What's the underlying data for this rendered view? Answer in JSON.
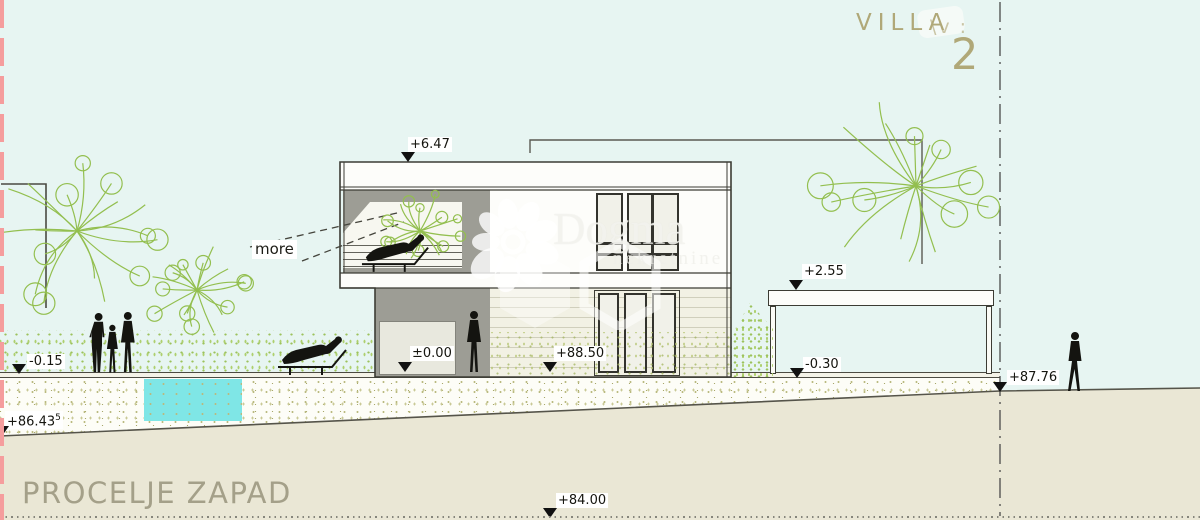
{
  "title": {
    "project": "VILLA",
    "ghost_text": "\\v :",
    "number": "2",
    "facade_name": "PROCELJE ZAPAD"
  },
  "annotations": {
    "more_label": "more"
  },
  "watermark": {
    "name": "Dogma",
    "subtitle": "nekretnine"
  },
  "elevation_markers": [
    {
      "id": "roof-level",
      "label": "+6.47",
      "label_x": 408,
      "label_y": 137,
      "tri_x": 401,
      "tri_y": 152
    },
    {
      "id": "ground-floor-level",
      "label": "±0.00",
      "label_x": 410,
      "label_y": 346,
      "tri_x": 398,
      "tri_y": 362
    },
    {
      "id": "absolute-8850",
      "label": "+88.50",
      "label_x": 554,
      "label_y": 346,
      "tri_x": 543,
      "tri_y": 362
    },
    {
      "id": "carport-roof-level",
      "label": "+2.55",
      "label_x": 802,
      "label_y": 264,
      "tri_x": 789,
      "tri_y": 280
    },
    {
      "id": "carport-floor-level",
      "label": "-0.30",
      "label_x": 803,
      "label_y": 357,
      "tri_x": 790,
      "tri_y": 368
    },
    {
      "id": "pool-deck-level",
      "label": "-0.15",
      "label_x": 27,
      "label_y": 354,
      "tri_x": 12,
      "tri_y": 364
    },
    {
      "id": "absolute-8643",
      "label": "+86.43",
      "sup": "5",
      "label_x": 5,
      "label_y": 411,
      "tri_x": -5,
      "tri_y": 426
    },
    {
      "id": "absolute-8776",
      "label": "+87.76",
      "label_x": 1007,
      "label_y": 370,
      "tri_x": 993,
      "tri_y": 382
    },
    {
      "id": "absolute-8400",
      "label": "+84.00",
      "label_x": 556,
      "label_y": 493,
      "tri_x": 543,
      "tri_y": 508
    }
  ],
  "scene": {
    "colors": {
      "sky": "#e7f5f2",
      "terrain_beige": "#eae7d5",
      "stipple_base": "#fdfdf7",
      "wall_gray": "#9d9d95",
      "siding": "#f2f1e4",
      "pool_cyan": "#7fe6e6",
      "tree_green": "#93bf4f",
      "boundary_red": "#f59d9d",
      "drawing_line": "#3c3c34",
      "title_olive": "#b0a878"
    },
    "trees": [
      {
        "id": "tree-garden-left-large",
        "cx": 77,
        "cy": 231,
        "r": 88,
        "seed": 1
      },
      {
        "id": "tree-garden-left-small",
        "cx": 197,
        "cy": 290,
        "r": 60,
        "seed": 2
      },
      {
        "id": "tree-terrace",
        "cx": 420,
        "cy": 231,
        "r": 46,
        "seed": 3
      },
      {
        "id": "tree-garden-right",
        "cx": 916,
        "cy": 186,
        "r": 102,
        "seed": 4
      }
    ],
    "people": [
      {
        "id": "person-standing-1",
        "pose": "standing",
        "x": 87,
        "y": 312,
        "h": 62
      },
      {
        "id": "person-standing-2",
        "pose": "standing-f",
        "x": 103,
        "y": 324,
        "h": 50
      },
      {
        "id": "person-standing-3",
        "pose": "standing-f",
        "x": 116,
        "y": 311,
        "h": 63
      },
      {
        "id": "person-lounger-garden",
        "pose": "lounger",
        "x": 276,
        "y": 336,
        "w": 74
      },
      {
        "id": "person-lounger-terrace",
        "pose": "lounger",
        "x": 360,
        "y": 234,
        "w": 72
      },
      {
        "id": "person-at-entry",
        "pose": "standing-f",
        "x": 462,
        "y": 310,
        "h": 64
      },
      {
        "id": "person-walking-right",
        "pose": "walking-f",
        "x": 1063,
        "y": 331,
        "h": 64
      }
    ]
  }
}
